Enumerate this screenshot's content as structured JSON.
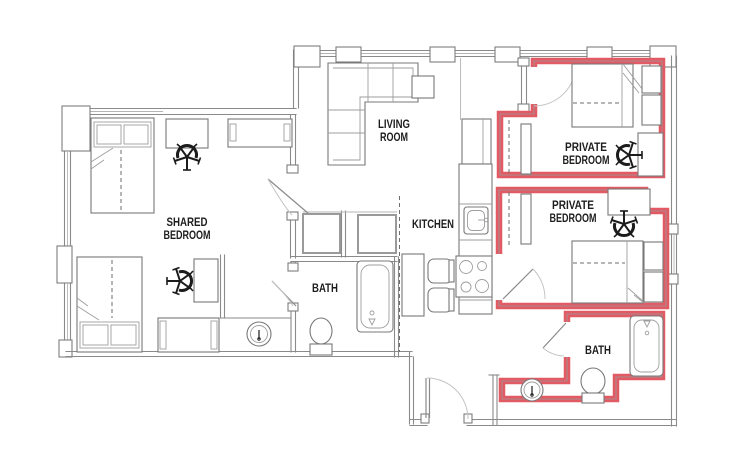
{
  "plan": {
    "colors": {
      "highlight": "#E25B64",
      "wall": "#8a8a8a",
      "furniture": "#787878",
      "text": "#1d1d1d",
      "background": "#ffffff"
    },
    "labels": {
      "shared_bedroom": [
        "SHARED",
        "BEDROOM"
      ],
      "living_room": [
        "LIVING",
        "ROOM"
      ],
      "kitchen": [
        "KITCHEN"
      ],
      "bath_shared": [
        "BATH"
      ],
      "private_bedroom_1": [
        "PRIVATE",
        "BEDROOM"
      ],
      "private_bedroom_2": [
        "PRIVATE",
        "BEDROOM"
      ],
      "bath_private": [
        "BATH"
      ]
    },
    "highlighted_rooms": [
      "private_bedroom_1",
      "private_bedroom_2",
      "bath_private"
    ]
  }
}
